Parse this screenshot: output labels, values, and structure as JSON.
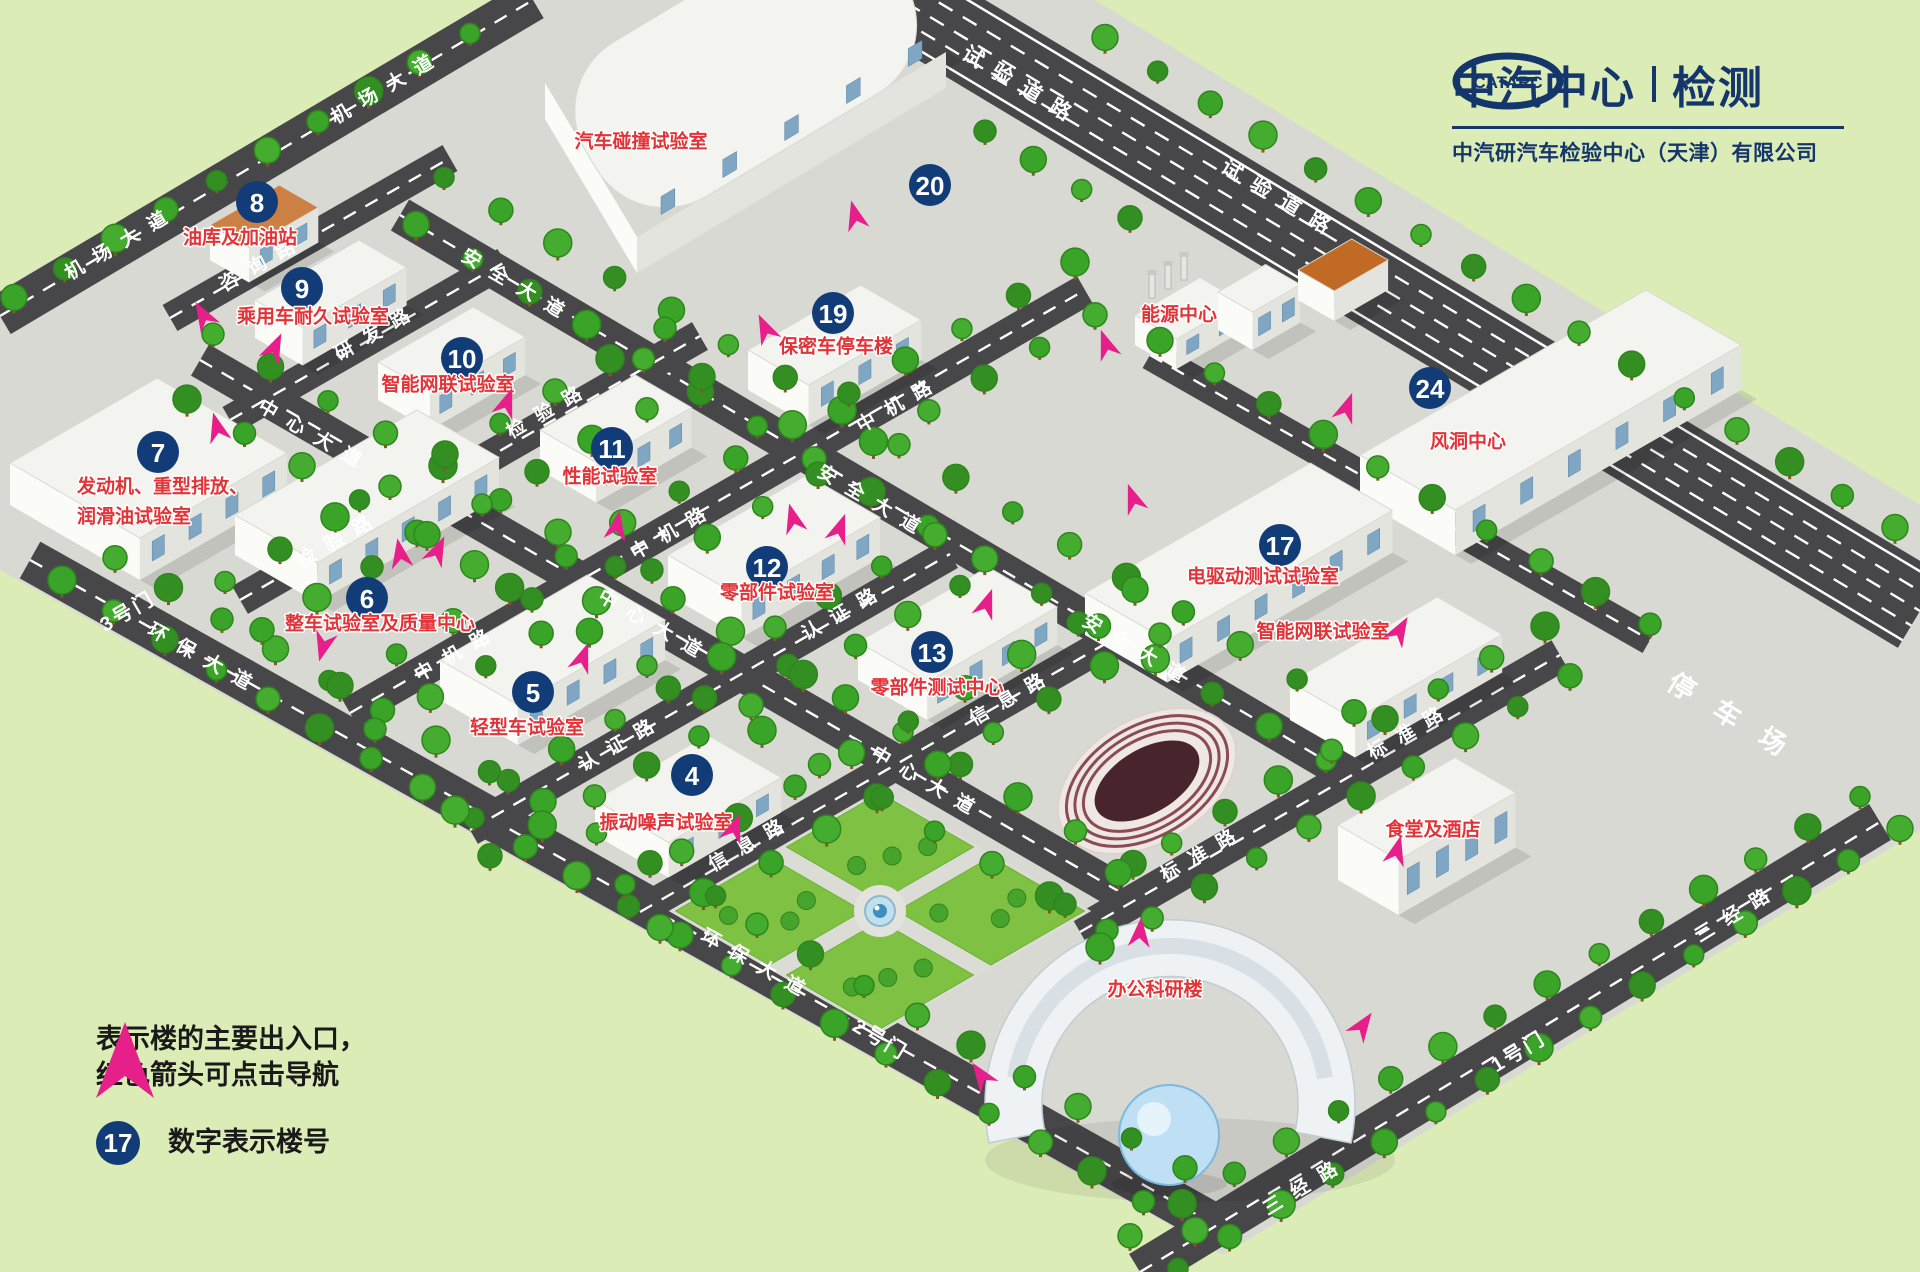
{
  "logo": {
    "mark": "CATARC",
    "title": "中汽中心",
    "suffix": "检测",
    "company": "中汽研汽车检验中心（天津）有限公司"
  },
  "legend": {
    "line1": "表示楼的主要出入口，",
    "line2": "红色箭头可点击导航",
    "badge": "17",
    "badge_desc": "数字表示楼号"
  },
  "roads": [
    {
      "id": "shiyan",
      "name": "试验道路"
    },
    {
      "id": "anquan",
      "name": "安全大道"
    },
    {
      "id": "zhongxin",
      "name": "中心大道"
    },
    {
      "id": "huanbao",
      "name": "环保大道"
    },
    {
      "id": "jichang",
      "name": "机场大道"
    },
    {
      "id": "zixun",
      "name": "咨询路"
    },
    {
      "id": "yanfa",
      "name": "研发路"
    },
    {
      "id": "jianyan",
      "name": "检验路"
    },
    {
      "id": "zhongji",
      "name": "中机路"
    },
    {
      "id": "renzheng",
      "name": "认证路"
    },
    {
      "id": "xinxi",
      "name": "信息路"
    },
    {
      "id": "biaozhun",
      "name": "标准路"
    },
    {
      "id": "sanjing",
      "name": "三经路"
    }
  ],
  "gates": [
    {
      "id": "gate1",
      "name": "1号门"
    },
    {
      "id": "gate2",
      "name": "2号门"
    },
    {
      "id": "gate3",
      "name": "3号门"
    }
  ],
  "areas": [
    {
      "id": "parking",
      "name": "停车场"
    }
  ],
  "buildings": [
    {
      "id": "b20",
      "num": "20",
      "name": "汽车碰撞试验室"
    },
    {
      "id": "b19",
      "num": "19",
      "name": "保密车停车楼"
    },
    {
      "id": "energy",
      "num": "",
      "name": "能源中心"
    },
    {
      "id": "b24",
      "num": "24",
      "name": "风洞中心"
    },
    {
      "id": "b17",
      "num": "17",
      "name": "电驱动测试试验室"
    },
    {
      "id": "intelli2",
      "num": "",
      "name": "智能网联试验室"
    },
    {
      "id": "b8",
      "num": "8",
      "name": "油库及加油站"
    },
    {
      "id": "b9",
      "num": "9",
      "name": "乘用车耐久试验室"
    },
    {
      "id": "b10",
      "num": "10",
      "name": "智能网联试验室"
    },
    {
      "id": "b11",
      "num": "11",
      "name": "性能试验室"
    },
    {
      "id": "b12",
      "num": "12",
      "name": "零部件试验室"
    },
    {
      "id": "b13",
      "num": "13",
      "name": "零部件测试中心"
    },
    {
      "id": "b7",
      "num": "7",
      "name": "发动机、重型排放、润滑油试验室",
      "lines": [
        "发动机、重型排放、",
        "润滑油试验室"
      ]
    },
    {
      "id": "b6",
      "num": "6",
      "name": "整车试验室及质量中心"
    },
    {
      "id": "b5",
      "num": "5",
      "name": "轻型车试验室"
    },
    {
      "id": "b4",
      "num": "4",
      "name": "振动噪声试验室"
    },
    {
      "id": "canteen",
      "num": "",
      "name": "食堂及酒店"
    },
    {
      "id": "office",
      "num": "",
      "name": "办公科研楼"
    }
  ],
  "colors": {
    "accent_red": "#e23438",
    "badge_navy": "#123c77",
    "arrow_pink": "#e61f8a",
    "logo_navy": "#15366b"
  }
}
